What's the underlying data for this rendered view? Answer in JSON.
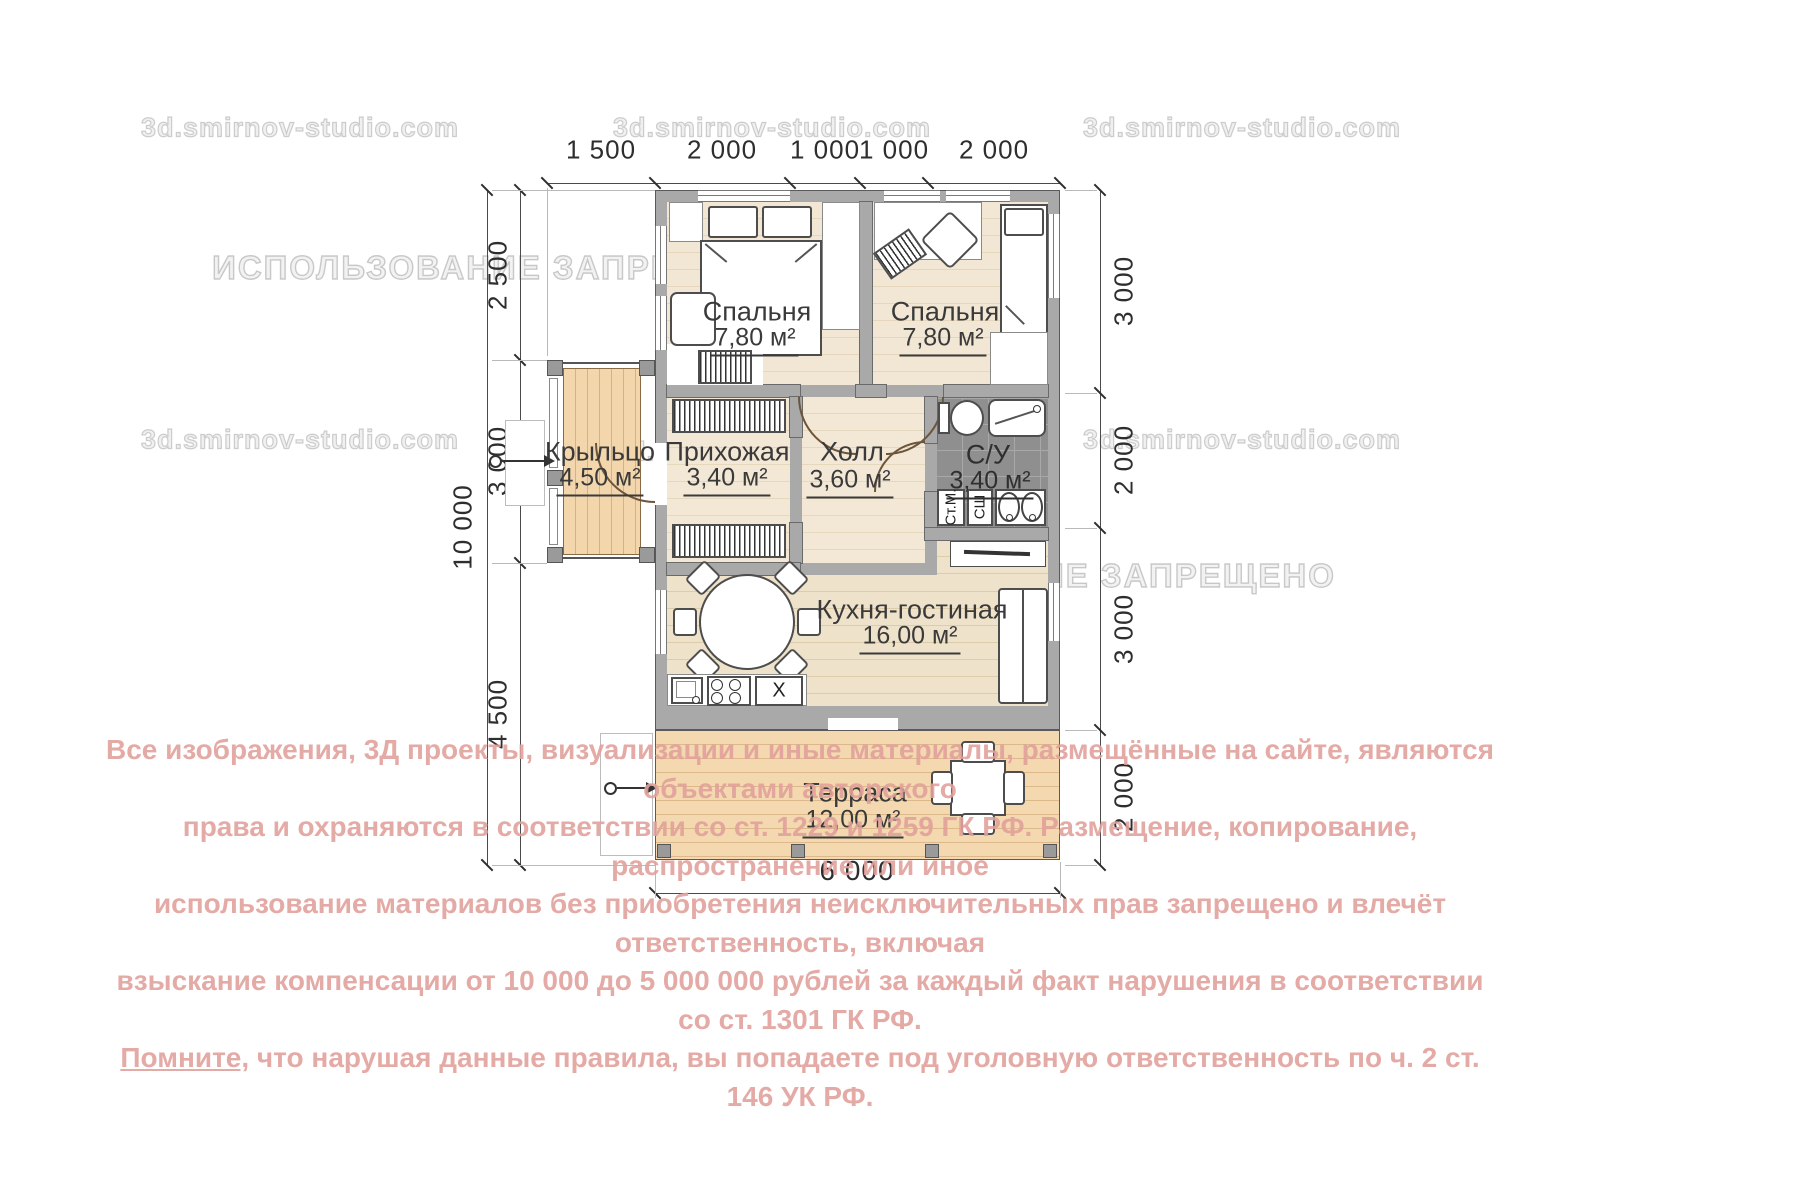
{
  "watermark": {
    "site": "3d.smirnov-studio.com",
    "forbidden": "ИСПОЛЬЗОВАНИЕ ЗАПРЕЩЕНО"
  },
  "rooms": {
    "bedroom1": {
      "name": "Спальня",
      "area": "7,80 м²"
    },
    "bedroom2": {
      "name": "Спальня",
      "area": "7,80 м²"
    },
    "porch": {
      "name": "Крыльцо",
      "area": "4,50 м²"
    },
    "entry": {
      "name": "Прихожая",
      "area": "3,40 м²"
    },
    "hall": {
      "name": "Холл",
      "area": "3,60 м²"
    },
    "bathroom": {
      "name": "С/У",
      "area": "3,40 м²"
    },
    "kitchen": {
      "name": "Кухня-гостиная",
      "area": "16,00 м²"
    },
    "terrace": {
      "name": "Терраса",
      "area": "12,00 м²"
    }
  },
  "appliances": {
    "washer": "Ст.М.",
    "dryer": "СШ",
    "cabinet": "X"
  },
  "dims": {
    "top": [
      "1 500",
      "2 000",
      "1 000",
      "1 000",
      "2 000"
    ],
    "left_total": "10 000",
    "left": [
      "2 500",
      "3 000",
      "4 500"
    ],
    "right": [
      "3 000",
      "2 000",
      "3 000",
      "2 000"
    ],
    "bottom": "6 000"
  },
  "copyright": {
    "lines": [
      "Все изображения, 3Д проекты, визуализации и иные материалы, размещённые на сайте, являются объектами авторского",
      "права и охраняются в соответствии со ст. 1229 и 1259 ГК РФ. Размещение, копирование, распространение или иное",
      "использование материалов без приобретения неисключительных прав запрещено и влечёт ответственность, включая",
      "взыскание компенсации от 10 000 до 5 000 000 рублей за каждый факт нарушения в соответствии со ст. 1301 ГК РФ."
    ],
    "line5_lead": "Помните,",
    "line5_rest": " что нарушая данные правила, вы попадаете под уголовную ответственность по ч. 2 ст. 146 УК РФ."
  },
  "colors": {
    "copyright_pink": "#e2a19c",
    "wall_gray": "#a9a9a9",
    "tile_gray": "#8f8f8f",
    "deck_wood": "#f3d6ab",
    "floor_wood": "#f2e7d4"
  }
}
